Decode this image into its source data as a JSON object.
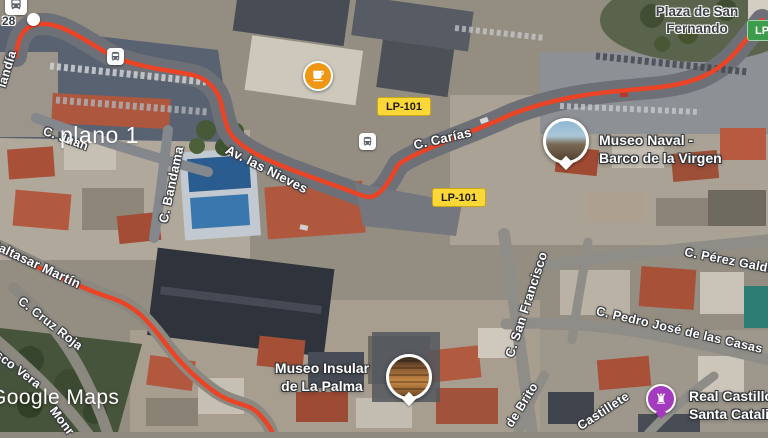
{
  "annotation": {
    "text": "plano 1"
  },
  "watermark": {
    "text": "Google Maps"
  },
  "fragments": {
    "left_edge_number": "28"
  },
  "shields": [
    {
      "id": "lp101_upper",
      "text": "LP-101"
    },
    {
      "id": "lp101_lower",
      "text": "LP-101"
    },
    {
      "id": "lp_green",
      "text": "LP"
    }
  ],
  "streets": [
    {
      "id": "landia",
      "text": "landía"
    },
    {
      "id": "c_juan",
      "text": "C. Juan"
    },
    {
      "id": "av_las_nieves",
      "text": "Av. las Nieves"
    },
    {
      "id": "c_bandama",
      "text": "C. Bandama"
    },
    {
      "id": "c_carias",
      "text": "C. Carías"
    },
    {
      "id": "baltasar_martin",
      "text": "Baltasar Martín"
    },
    {
      "id": "c_cruz_roja",
      "text": "C. Cruz Roja"
    },
    {
      "id": "cisco_vera",
      "text": "cisco Vera"
    },
    {
      "id": "monr",
      "text": "Monr"
    },
    {
      "id": "c_san_francisco",
      "text": "C. San Francisco"
    },
    {
      "id": "c_perez_galdos",
      "text": "C. Pérez Galdós"
    },
    {
      "id": "c_pedro_jose",
      "text": "C. Pedro José de las Casas"
    },
    {
      "id": "de_brito",
      "text": "de Brito"
    },
    {
      "id": "castillete",
      "text": "Castillete"
    }
  ],
  "pois": [
    {
      "id": "plaza_san_fernando",
      "lines": [
        "Plaza de San",
        "Fernando"
      ]
    },
    {
      "id": "museo_naval",
      "lines": [
        "Museo Naval -",
        "Barco de la Virgen"
      ]
    },
    {
      "id": "museo_insular",
      "lines": [
        "Museo Insular",
        "de La Palma"
      ]
    },
    {
      "id": "real_castillo",
      "lines": [
        "Real Castillo de",
        "Santa Catalina"
      ]
    }
  ],
  "icons": {
    "castle_glyph": "♜",
    "bus": "bus-icon",
    "cafe": "cafe-icon",
    "transit_station": "bus-station-icon"
  },
  "colors": {
    "route_color": "#ea4326",
    "shield_yellow": "#fbd838",
    "shield_green": "#3d9b4c",
    "marker_purple": "#a43bbf",
    "marker_amber": "#ef9613"
  }
}
